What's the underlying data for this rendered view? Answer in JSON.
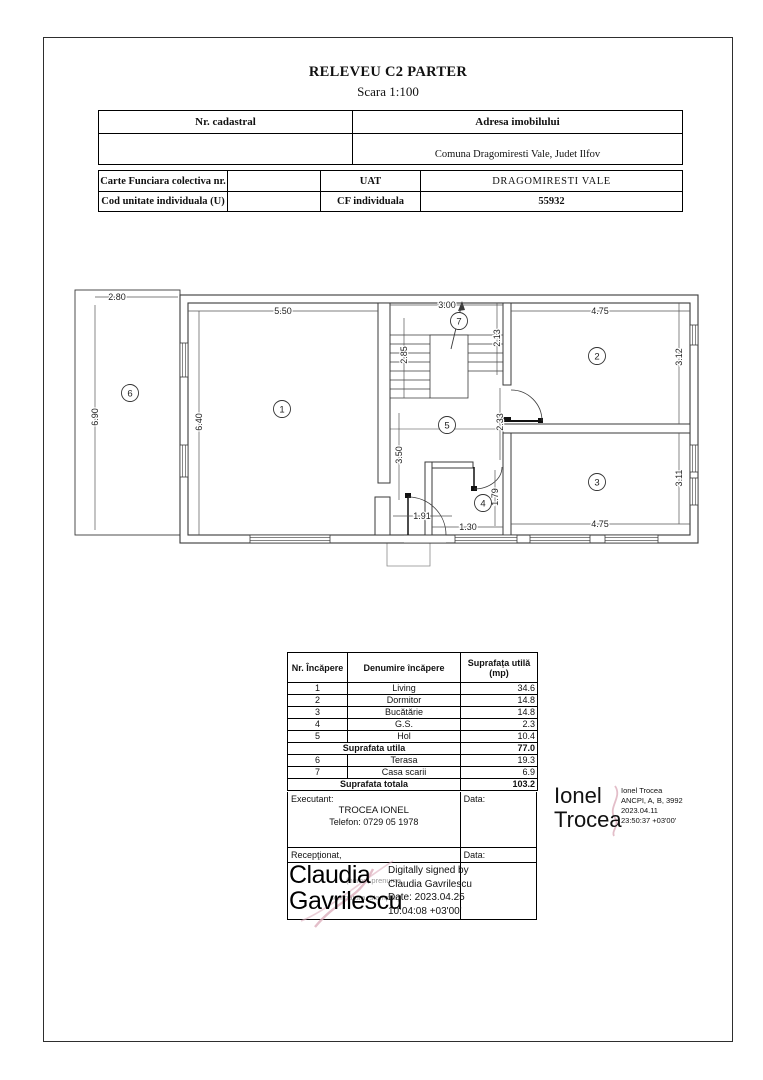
{
  "page": {
    "title": "RELEVEU C2 PARTER",
    "subtitle": "Scara 1:100"
  },
  "cadastral_table": {
    "nr_cadastral_label": "Nr. cadastral",
    "nr_cadastral_value": "",
    "address_label": "Adresa imobilului",
    "address_value": "Comuna Dragomiresti Vale, Judet Ilfov"
  },
  "cf_table": {
    "carte_funciara_label": "Carte Funciara colectiva nr.",
    "carte_funciara_value": "",
    "uat_label": "UAT",
    "uat_value": "DRAGOMIRESTI VALE",
    "cod_unitate_label": "Cod unitate individuala (U)",
    "cod_unitate_value": "",
    "cf_individuala_label": "CF individuala",
    "cf_individuala_value": "55932"
  },
  "floor_plan": {
    "rooms": [
      "1",
      "2",
      "3",
      "4",
      "5",
      "6",
      "7"
    ],
    "dims": {
      "terrace_w": "2.80",
      "terrace_h": "6.90",
      "living_w": "5.50",
      "living_h": "6.40",
      "stairs_w": "3.00",
      "stairs_left": "2.85",
      "stairs_right": "2.13",
      "dorm_w": "4.75",
      "dorm_h": "3.12",
      "hall_v": "2.33",
      "hall_h": "3.50",
      "kitchen_w": "4.75",
      "kitchen_h": "3.11",
      "gs_h": "1.79",
      "gs_w": "1.30",
      "entry_w": "1.91"
    }
  },
  "room_table": {
    "headers": {
      "nr": "Nr. Încăpere",
      "name": "Denumire încăpere",
      "area1": "Suprafața utilă",
      "area2": "(mp)"
    },
    "rows": [
      {
        "nr": "1",
        "name": "Living",
        "area": "34.6"
      },
      {
        "nr": "2",
        "name": "Dormitor",
        "area": "14.8"
      },
      {
        "nr": "3",
        "name": "Bucătărie",
        "area": "14.8"
      },
      {
        "nr": "4",
        "name": "G.S.",
        "area": "2.3"
      },
      {
        "nr": "5",
        "name": "Hol",
        "area": "10.4"
      }
    ],
    "subtotal": {
      "label": "Suprafata utila",
      "value": "77.0"
    },
    "rows2": [
      {
        "nr": "6",
        "name": "Terasa",
        "area": "19.3"
      },
      {
        "nr": "7",
        "name": "Casa scarii",
        "area": "6.9"
      }
    ],
    "total": {
      "label": "Suprafata totala",
      "value": "103.2"
    }
  },
  "executant": {
    "label": "Executant:",
    "name": "TROCEA IONEL",
    "phone": "Telefon: 0729 05 1978",
    "data_label": "Data:"
  },
  "receptionat": {
    "label": "Recepţionat,",
    "data_label": "Data:",
    "form_hint1": "(nume, prenume,",
    "form_hint2": "semnatura, stampila)"
  },
  "signatures": {
    "claudia": {
      "big_line1": "Claudia",
      "big_line2": "Gavrilescu",
      "digital": [
        "Digitally signed by",
        "Claudia Gavrilescu",
        "Date: 2023.04.25",
        "10:04:08 +03'00'"
      ]
    },
    "ionel": {
      "big_line1": "Ionel",
      "big_line2": "Trocea",
      "details": [
        "Ionel Trocea",
        "ANCPI, A, B, 3992",
        "2023.04.11",
        "23:50:37 +03'00'"
      ]
    }
  }
}
